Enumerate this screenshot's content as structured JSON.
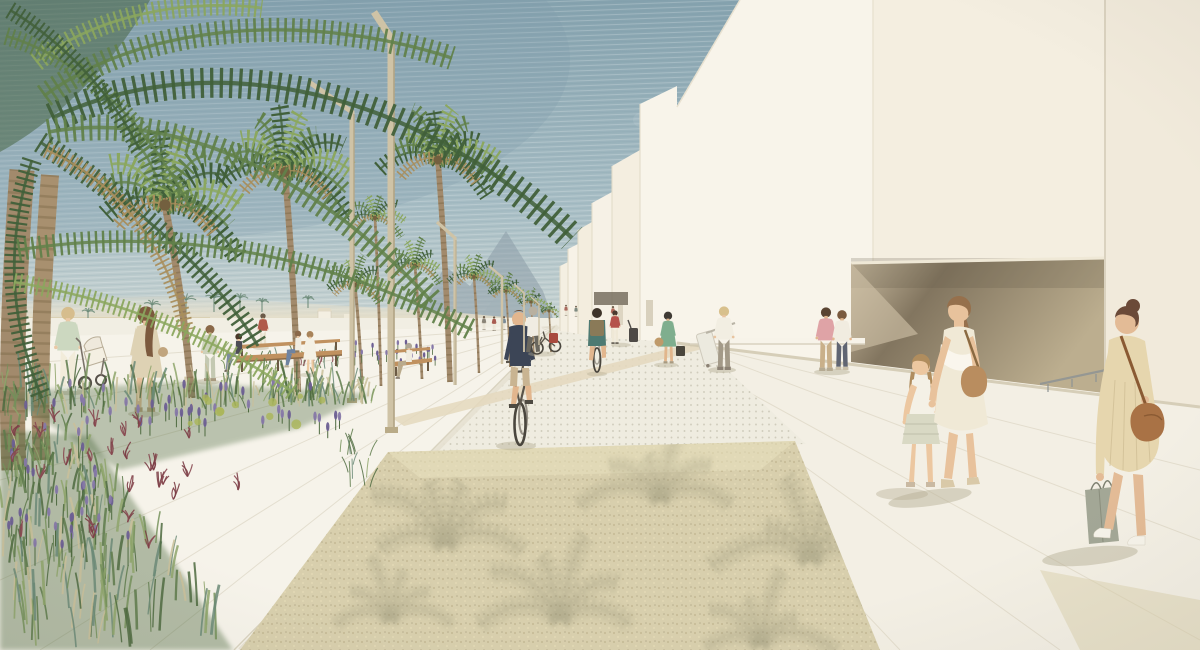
{
  "scene": {
    "type": "architectural-rendering",
    "description": "Watercolor-style visualization of a seaside promenade: a palm-lined boulevard with a dotted cycle path receding to a vanishing point, minimalist white buildings with a deep recessed opening on the right, a lush planting bed of grasses and lavender in the left foreground, a gravel plaza with palm-frond shadows, and pedestrians and cyclists throughout.",
    "style": "hand-drawn watercolor and pencil render",
    "time_of_day": "bright daylight"
  },
  "palette": {
    "sky_top": "#85a2ae",
    "sky_mid": "#a7bdc4",
    "sky_soft": "#c6d2d1",
    "sky_horizon": "#e4e4da",
    "mountain_far": "#8c9da8",
    "mountain_near": "#a2b1b8",
    "dune": "#e7dec6",
    "dune_deep": "#d8cba8",
    "sea_hint": "#c3ccc8",
    "gabion": "#6b6156",
    "gabion_light": "#93887a",
    "building_front": "#f8f4ea",
    "building_panel": "#f4eee0",
    "building_side": "#f1eadb",
    "building_far": "#f6f1e6",
    "recess_dark": "#82755f",
    "recess_light": "#bcae8f",
    "recess_wedge": "#cdbfa4",
    "ground": "#f1eee3",
    "promenade": "#f6f3ea",
    "walkway": "#f3efe4",
    "plaza": "#efece0",
    "plaza_dot": "#c5c1b0",
    "road_edge": "#d9d3c0",
    "cross_strip": "#e4d8bd",
    "gravel": "#d8cfad",
    "gravel_dark": "#b5ab8a",
    "gravel_light": "#e9e1bf",
    "gravel_shadow": "#8f8c70",
    "lamp": "#cfc3a6",
    "lamp_shade": "#ab9d7d",
    "bench_wood": "#c0915f",
    "bench_dark": "#6b5a44",
    "trunk": "#a28a6c",
    "trunk_dark": "#73603f",
    "palm_dark": "#41603a",
    "palm_mid": "#61814a",
    "palm_light": "#8ba75e",
    "palm_dry": "#a98e5c",
    "grass1": "#5d7a4a",
    "grass2": "#74905a",
    "grass3": "#8ea46b",
    "grass4": "#6b8a77",
    "grass5": "#4e6a40",
    "grass_wheat": "#c9c09a",
    "lavender": "#8678a8",
    "lavender_deep": "#6d5f94",
    "maroon": "#8a4a52",
    "chartreuse": "#aab558",
    "shadow": "#b3ac92",
    "skin": "#e8c4a0",
    "white_wall": "#f7f3e9"
  },
  "elements": {
    "sky": "hazy blue-gray hatched sky",
    "mountains": "two faint peaks at the end of the boulevard",
    "dunes": "pale beach and dune grass beyond the gabion wall",
    "gabion_wall": "low stone-filled wall edging the promenade",
    "beach_hut": "tiny white cabin on the horizon",
    "buildings": {
      "count": 7,
      "style": "white minimalist volumes receding in perspective",
      "feature": "deep recessed opening with dark timber soffit"
    },
    "street_lamps": {
      "count": 6,
      "style": "bent rectangular masts in beige steel"
    },
    "palm_trees": {
      "row_count": 10,
      "foreground_count": 2,
      "shoreline_count": 7
    },
    "benches": {
      "count": 2,
      "material": "timber slats"
    },
    "pavements": [
      "promenade slabs",
      "dotted cycle-path paving",
      "aggregate gravel plaza",
      "concrete walkway"
    ],
    "planting": [
      "ornamental grasses",
      "lavender spikes",
      "red fountain grass",
      "chartreuse shrubs"
    ],
    "railing": "steel handrail at the building base",
    "objects": [
      "stroller",
      "bicycles",
      "rolling suitcases",
      "shopping bag",
      "handbags"
    ]
  },
  "people": {
    "stroller_woman": {
      "label": "woman pushing a stroller",
      "top": "#ccd8c0",
      "bottom": "#f2ecda",
      "hair": "#d6bd8d",
      "skin": "#eac9a6",
      "shoe": "#fbfaf3"
    },
    "beige_dress_woman": {
      "label": "woman in beige dress walking left",
      "top": "#ded2b4",
      "bottom": "#e6c09c",
      "hair": "#7c5a3e",
      "skin": "#e6c09c",
      "shoe": "#b99f7e"
    },
    "sage_coat_woman": {
      "label": "standing woman in sage coat",
      "top": "#cdd2bb",
      "bottom": "#c4c9b2",
      "hair": "#8a6848",
      "skin": "#e8c4a0",
      "shoe": "#a89a80"
    },
    "red_shirt_man": {
      "label": "man in red shirt",
      "top": "#b05a4a",
      "bottom": "#e9e2cf",
      "hair": "#6b5a48",
      "skin": "#e8c4a0",
      "shoe": "#8c8274"
    },
    "bench_sitter_dark": {
      "label": "woman in dark top sitting on bench",
      "top": "#4d4c55",
      "bottom": "#7e8ca0",
      "hair": "#4a3828",
      "skin": "#e8c4a0",
      "shoe": "#6d675c"
    },
    "bench_sitter_white": {
      "label": "woman in white top sitting on bench",
      "top": "#f1ede1",
      "bottom": "#6f83a0",
      "hair": "#8a6848",
      "skin": "#e8c4a0",
      "shoe": "#b5aa92"
    },
    "standing_girl": {
      "label": "girl in white dress by the bench",
      "top": "#f4f0e4",
      "bottom": "#f4f0e4",
      "hair": "#a8835a",
      "skin": "#ecc7a0",
      "shoe": "#c9b9a2"
    },
    "bench_c_sitter": {
      "label": "person seated on far bench",
      "top": "#f0ece0",
      "bottom": "#b9aa8c",
      "hair": "#b0a795",
      "skin": "#e8c4a0",
      "shoe": "#8c8274"
    },
    "cyclist_front": {
      "label": "cyclist in navy tee riding toward viewer",
      "top": "#3c4556",
      "bottom": "#c9b492",
      "hair": "#6b4a30",
      "skin": "#e2b68e",
      "shoe": "#4e4a42"
    },
    "bike_pusher": {
      "label": "man walking a bicycle with red pannier",
      "top": "#f0ece2",
      "bottom": "#6a675e",
      "hair": "#b8b0a0",
      "skin": "#e8c4a0",
      "bag": "#a84a3e"
    },
    "cyclist_away": {
      "label": "cyclist in teal with backpack riding away",
      "top": "#4e7a72",
      "bottom": "#5a5448",
      "hair": "#3e342a",
      "skin": "#e2b68e",
      "bag": "#8a7a58"
    },
    "red_top_traveler": {
      "label": "woman in red top with dark suitcase",
      "top": "#b5524c",
      "bottom": "#efe8d6",
      "hair": "#4a3a30",
      "skin": "#e8c4a0",
      "case": "#4e4a46",
      "shoe": "#6d675c"
    },
    "green_dress_woman": {
      "label": "woman in green dress with handbag",
      "top": "#7fae8e",
      "bottom": "#7fae8e",
      "hair": "#3f3a34",
      "skin": "#e1b68c",
      "bag": "#bf9a6a",
      "case": "#4a463c",
      "shoe": "#a89a80"
    },
    "suitcase_woman": {
      "label": "woman in checked skirt pulling white suitcase",
      "top": "#f2eee2",
      "bottom": "#a39a88",
      "hair": "#d8c08c",
      "skin": "#e8c4a0",
      "case": "#eceadf",
      "shoe": "#8c8274"
    },
    "pink_shirt_man": {
      "label": "man in pink tee, arm around partner",
      "top": "#dfa3a6",
      "bottom": "#c9b08a",
      "hair": "#5a4432",
      "skin": "#e3b78f",
      "shoe": "#b5aa92"
    },
    "couple_woman": {
      "label": "woman in white top and dark jeans",
      "top": "#f1ece0",
      "bottom": "#606572",
      "hair": "#7a5a3e",
      "skin": "#e3b78f",
      "shoe": "#c9bfa8"
    },
    "girl_with_braids": {
      "label": "girl with braids in ruffled skirt",
      "top": "#f4f1e6",
      "bottom": "#d9d9c4",
      "hair": "#b08d5e",
      "skin": "#ecc7a0",
      "shoe": "#c9b9a2",
      "tie": "#c04a3a"
    },
    "mother_in_ruffle_dress": {
      "label": "mother in cream one-shoulder ruffle dress",
      "top": "#f0e9d6",
      "hair": "#96704c",
      "skin": "#e8c29c",
      "bag": "#b98d5f",
      "shoe": "#d9c9a8"
    },
    "shopper_with_bag": {
      "label": "woman in beige dress with crossbody bag and shopping bag",
      "top": "#e6d6ae",
      "hair": "#6b4a38",
      "skin": "#e3bb96",
      "bag": "#a97245",
      "shopping": "#a3a796",
      "shoe": "#f6f3ea"
    },
    "distant_pedestrians": {
      "label": "small figures near the vanishing point",
      "count": 7,
      "colors": [
        "#8a8478",
        "#a85b50",
        "#7a8a96",
        "#988a6e",
        "#aa6a5e",
        "#7e8a80",
        "#b0675a"
      ]
    }
  }
}
